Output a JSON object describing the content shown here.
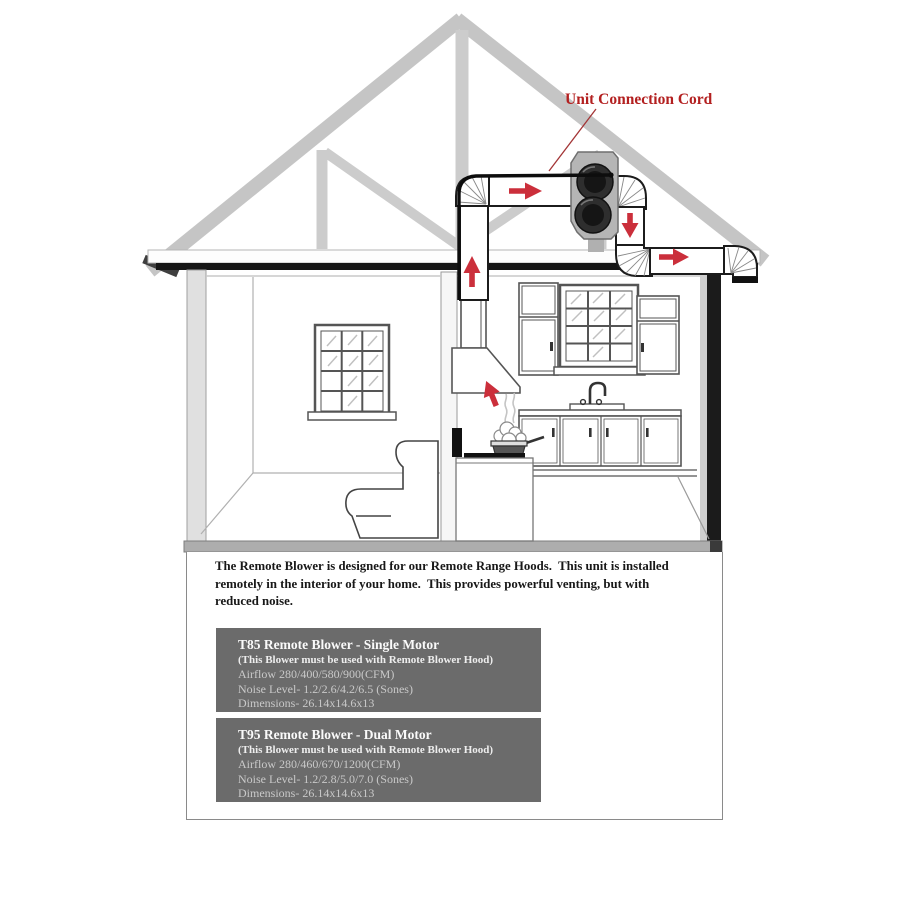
{
  "diagram": {
    "cord_label": "Unit Connection Cord",
    "colors": {
      "label_red": "#b32020",
      "arrow_red": "#cb2f3b",
      "truss_gray": "#c6c6c6",
      "product_box_gray": "#6b6b6b"
    }
  },
  "panel": {
    "description": "The Remote Blower is designed for our Remote Range Hoods.  This unit is installed\nremotely in the interior of your home.  This provides powerful venting, but with\nreduced noise.",
    "products": [
      {
        "title": "T85 Remote Blower - Single Motor",
        "note": "(This Blower must be used with Remote Blower Hood)",
        "airflow": "Airflow 280/400/580/900(CFM)",
        "noise": "Noise Level- 1.2/2.6/4.2/6.5 (Sones)",
        "dimensions": "Dimensions- 26.14x14.6x13"
      },
      {
        "title": "T95 Remote Blower - Dual Motor",
        "note": "(This Blower must be used with Remote Blower Hood)",
        "airflow": "Airflow 280/460/670/1200(CFM)",
        "noise": "Noise Level- 1.2/2.8/5.0/7.0 (Sones)",
        "dimensions": "Dimensions- 26.14x14.6x13"
      }
    ]
  }
}
